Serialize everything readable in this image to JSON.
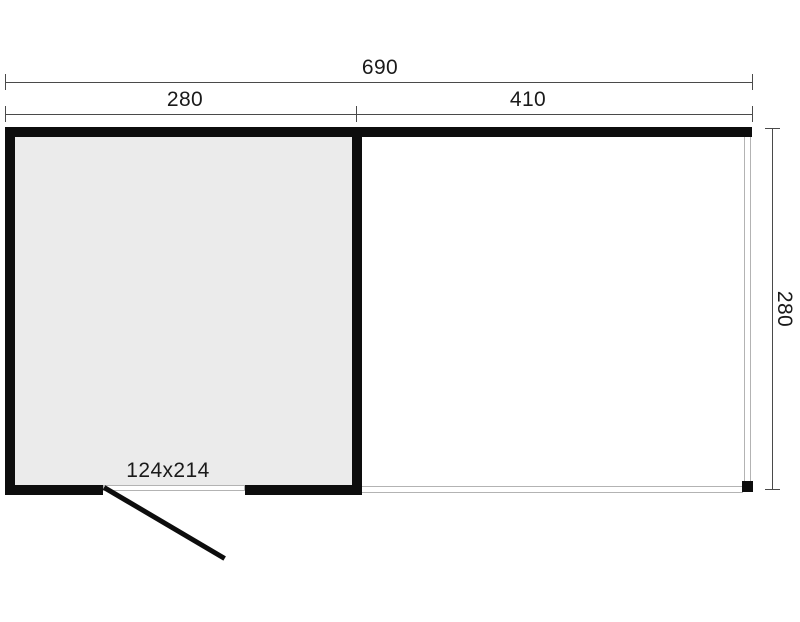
{
  "colors": {
    "wall": "#0d0d0d",
    "room-fill": "#ebebeb",
    "thin-line": "#b3b3b3",
    "dim-line": "#4a4a4a",
    "text": "#1a1a1a",
    "background": "#ffffff"
  },
  "dimensions": {
    "overall_width": "690",
    "room_width": "280",
    "canopy_width": "410",
    "depth": "280",
    "door_size": "124x214"
  }
}
